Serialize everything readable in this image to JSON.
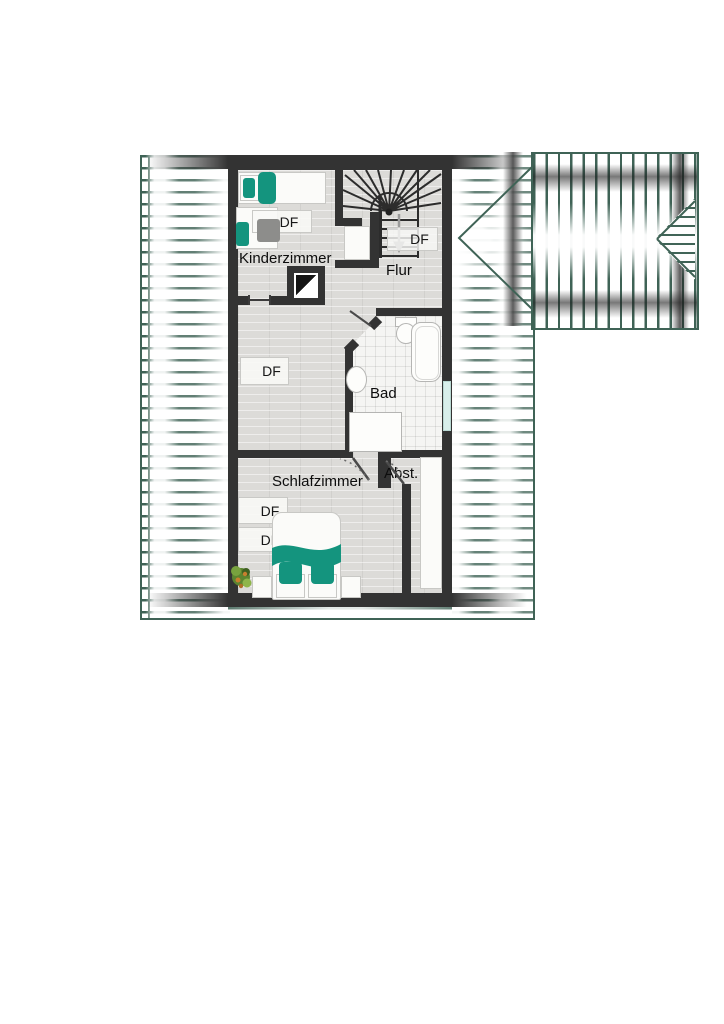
{
  "plan": {
    "type": "floor-plan-top-view",
    "rooms": [
      {
        "id": "kinderzimmer",
        "label": "Kinderzimmer"
      },
      {
        "id": "flur",
        "label": "Flur"
      },
      {
        "id": "bad",
        "label": "Bad"
      },
      {
        "id": "schlafzimmer",
        "label": "Schlafzimmer"
      },
      {
        "id": "abstellraum",
        "label": "Abst."
      }
    ]
  },
  "labels": {
    "kinderzimmer": "Kinderzimmer",
    "flur": "Flur",
    "bad": "Bad",
    "schlafzimmer": "Schlafzimmer",
    "abstellraum": "Abst.",
    "df": "DF"
  },
  "colors": {
    "wall": "#333333",
    "roof_line": "#3f6356",
    "accent_teal": "#14947e",
    "floor": "#dcdbd8",
    "tile": "#f5f5f3",
    "glass": "#d8efeb",
    "arrow_gray": "#9b9b9b",
    "plant_green": "#5c8530"
  }
}
